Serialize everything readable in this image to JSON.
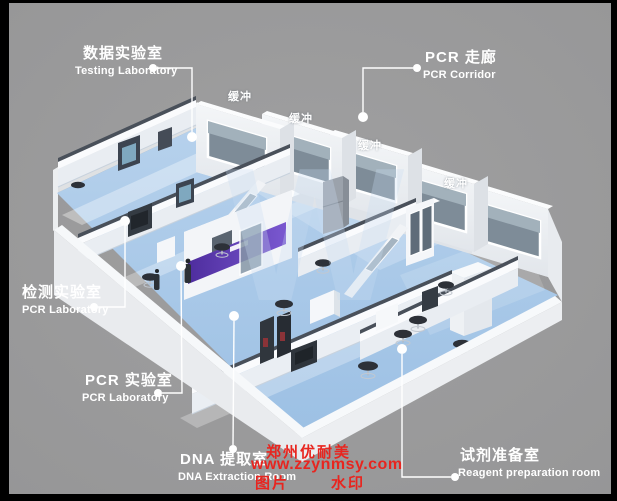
{
  "callouts": [
    {
      "id": "testing-laboratory",
      "zh": "数据实验室",
      "en": "Testing Laboratory"
    },
    {
      "id": "pcr-corridor",
      "zh": "PCR 走廊",
      "en": "PCR Corridor"
    },
    {
      "id": "inspection-laboratory",
      "zh": "检测实验室",
      "en": "PCR Laboratory"
    },
    {
      "id": "pcr-laboratory",
      "zh": "PCR 实验室",
      "en": "PCR Laboratory"
    },
    {
      "id": "dna-extraction-room",
      "zh": "DNA 提取室",
      "en": "DNA Extraction Room"
    },
    {
      "id": "reagent-preparation-room",
      "zh": "试剂准备室",
      "en": "Reagent preparation room"
    }
  ],
  "buffer_label": "缓冲",
  "background_logo": "W",
  "watermark": {
    "company": "郑州优耐美",
    "website": "www.zzynmsy.com",
    "tag_left": "图片",
    "tag_right": "水印"
  },
  "colors": {
    "background_gray": "#9b9b9c",
    "frame_black": "#000000",
    "floor_blue": "#a9c8e8",
    "wall_white": "#f2f4f6",
    "window_glass": "#7e8c98",
    "accent_purple": "#5a36b0",
    "stool_dark": "#2d3138",
    "callout_text": "#ffffff",
    "watermark_red": "#e8251f"
  }
}
